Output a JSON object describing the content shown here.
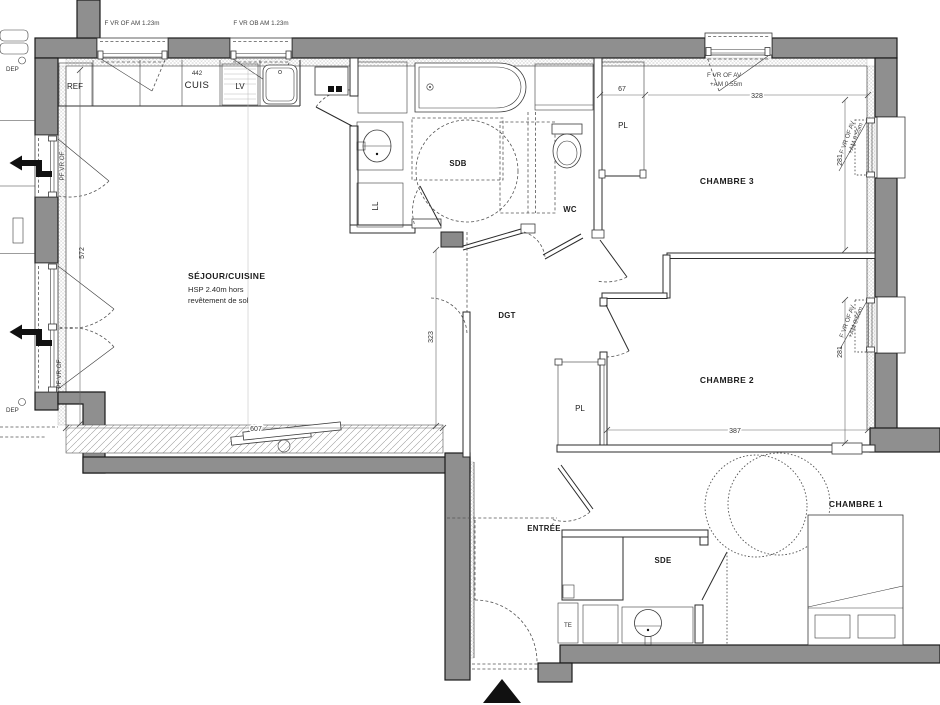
{
  "plan": {
    "rooms": {
      "sejour_name": "SÉJOUR/CUISINE",
      "sejour_hsp1": "HSP 2.40m hors",
      "sejour_hsp2": "revêtement de sol",
      "sdb": "SDB",
      "wc": "WC",
      "dgt": "DGT",
      "entree": "ENTRÉE",
      "sde": "SDE",
      "chambre1": "CHAMBRE 1",
      "chambre2": "CHAMBRE 2",
      "chambre3": "CHAMBRE 3"
    },
    "fixtures": {
      "ref": "REF",
      "cuis_num": "442",
      "cuis": "CUIS",
      "lv": "LV",
      "ll": "LL",
      "pl": "PL",
      "te": "TE",
      "dep": "DEP"
    },
    "windows": {
      "top1": "F VR OF AM 1.23m",
      "top2": "F VR OB AM 1.23m",
      "av1": "F VR OF AV",
      "av2": "+AM 0.55m",
      "pf": "PF VR OF"
    },
    "dims": {
      "d572": "572",
      "d607": "607",
      "d323": "323",
      "d67": "67",
      "d328": "328",
      "d281a": "281",
      "d281b": "281",
      "d387": "387"
    }
  }
}
